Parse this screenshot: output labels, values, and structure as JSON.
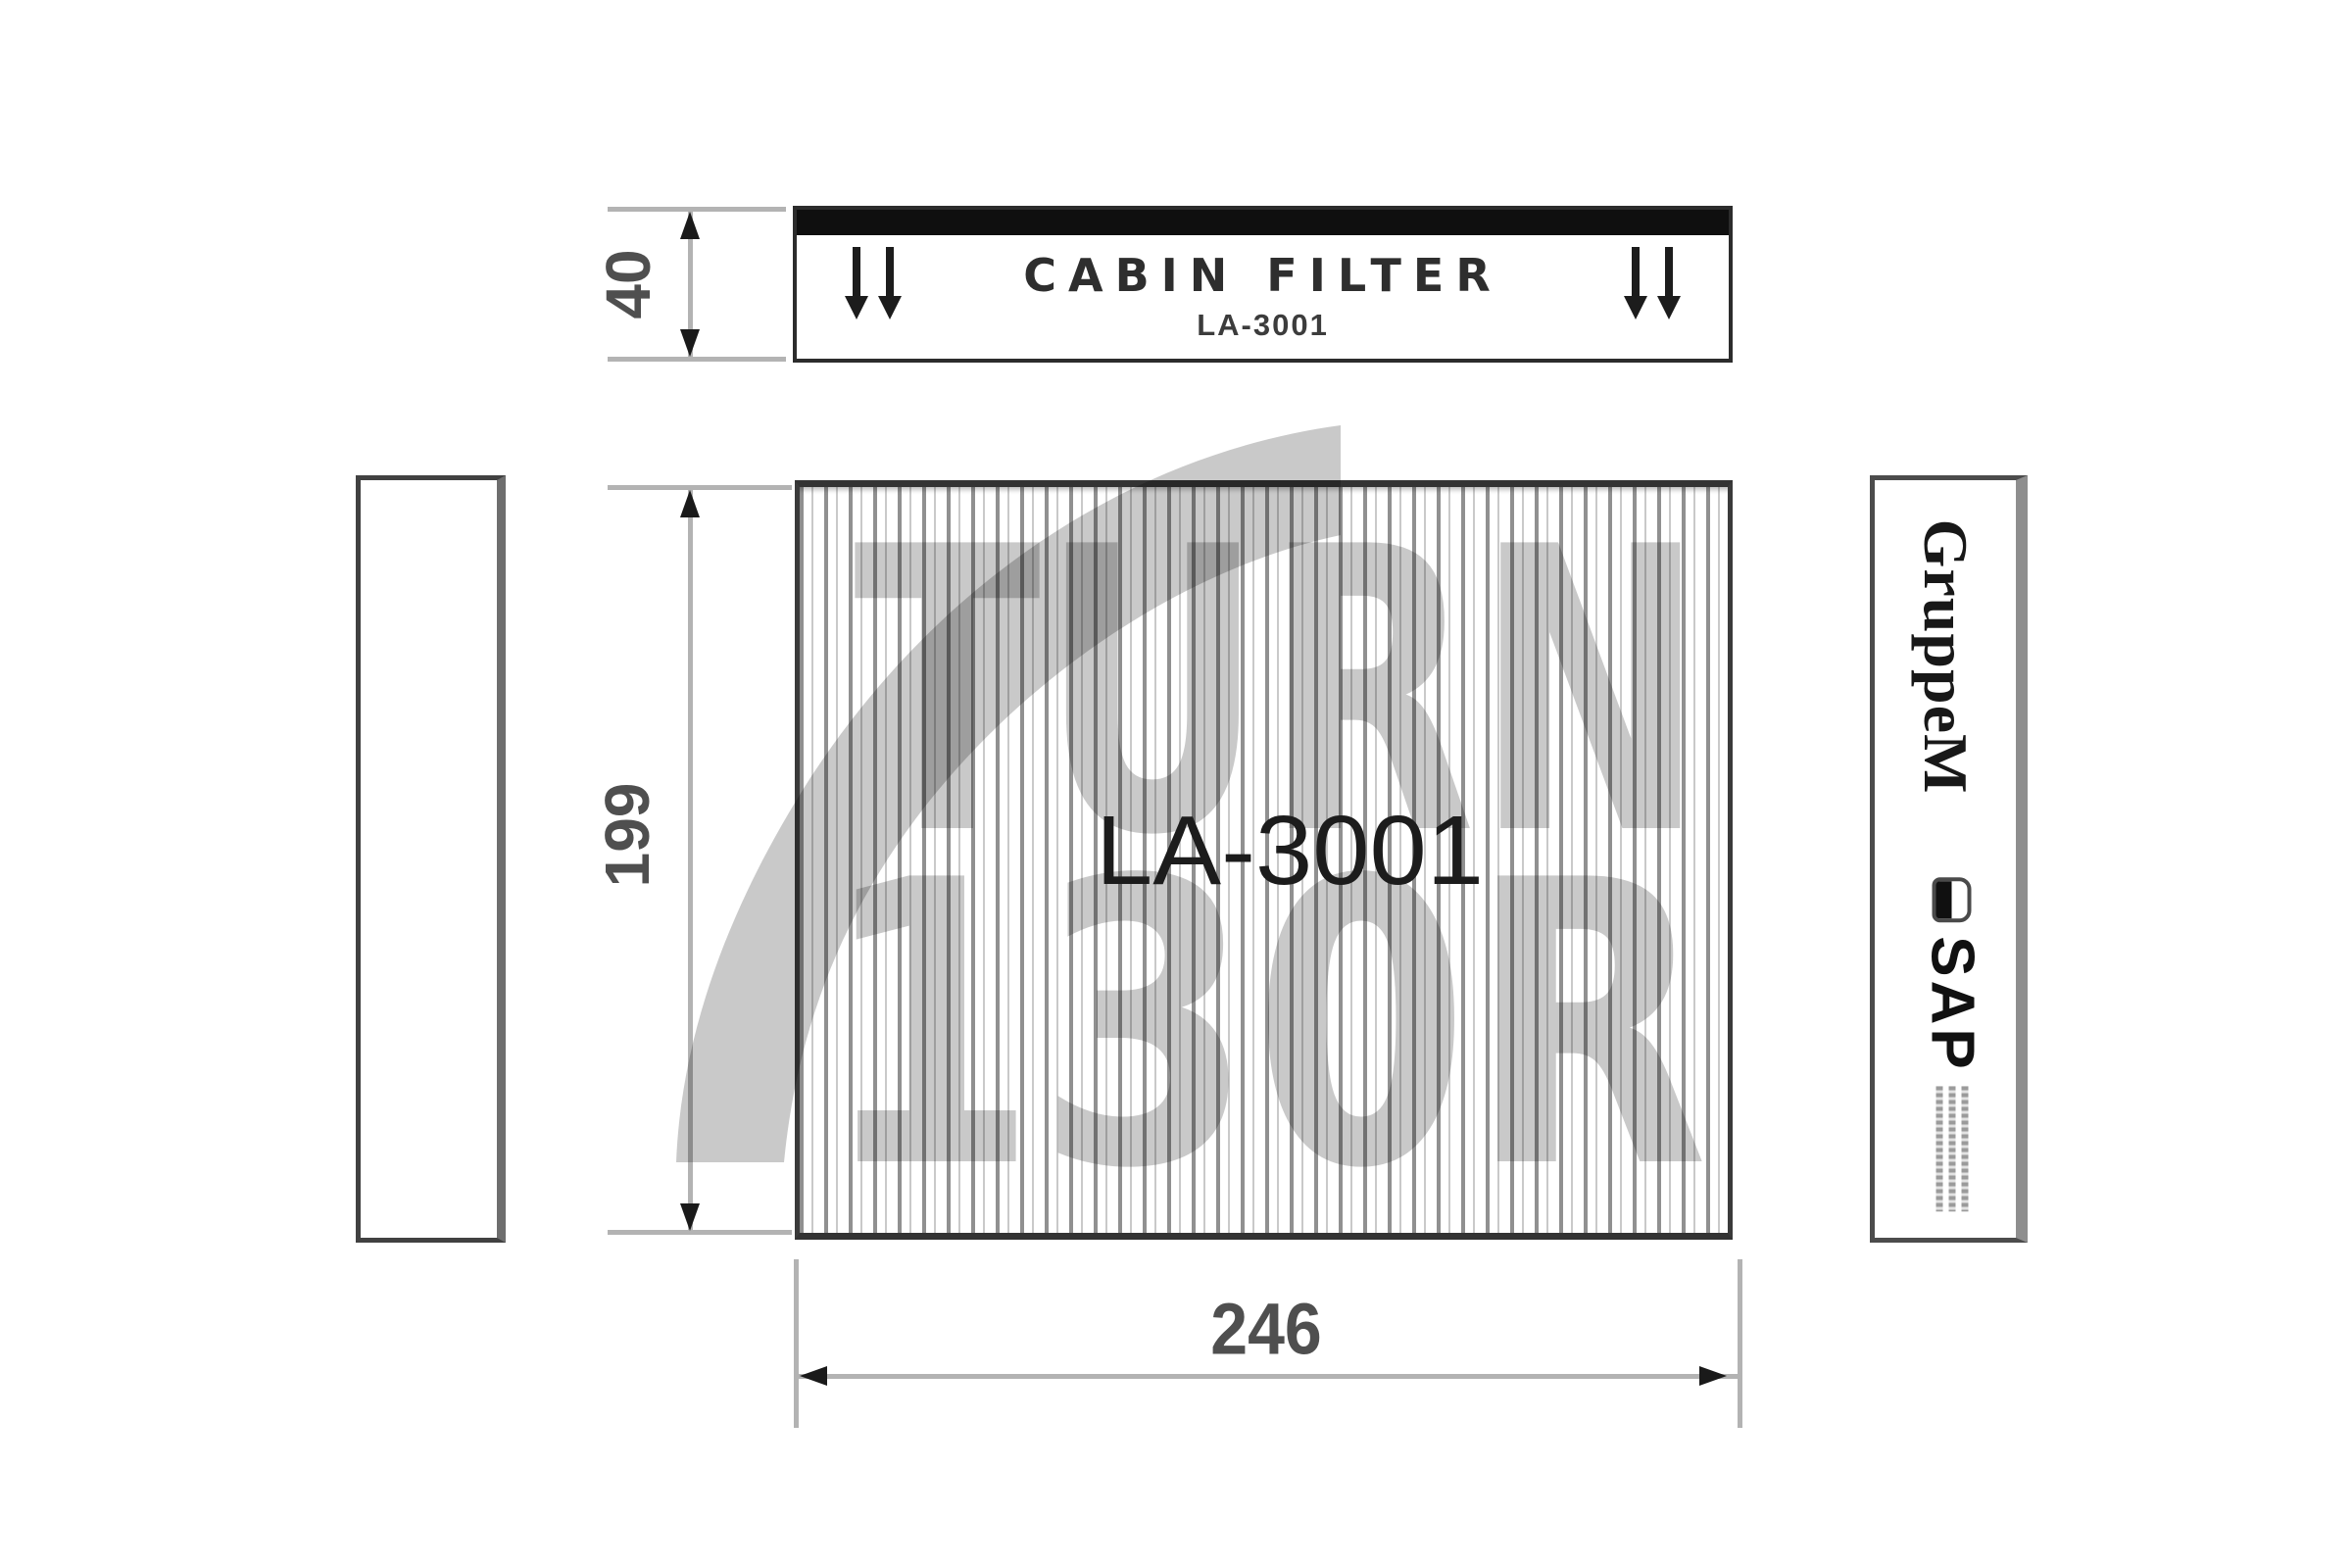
{
  "top_label": {
    "title": "CABIN FILTER",
    "part_number": "LA-3001",
    "arrow_icon": "double-down-arrow"
  },
  "dimensions": {
    "label_thickness": "40",
    "filter_height": "199",
    "filter_width": "246"
  },
  "filter_face": {
    "part_number": "LA-3001"
  },
  "watermark": {
    "line1": "TURN",
    "line2": "130R",
    "shape": "curved-sail-swoosh",
    "color": "rgba(0,0,0,0.21)"
  },
  "right_label": {
    "brand": "GruppeM",
    "product": "SAP",
    "icon": "helmet-icon",
    "fine_print_lines": 3,
    "fine_print_legible": false
  },
  "colors": {
    "frame_dark": "#333333",
    "dimension_line_gray": "#b3b3b3",
    "arrowhead_black": "#1a1a1a",
    "text_dark": "#2e2e2e",
    "pleat_gray": "#909090"
  }
}
